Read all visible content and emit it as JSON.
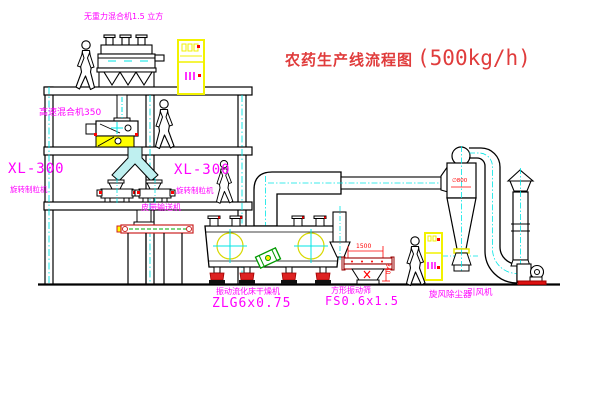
{
  "title": {
    "text": "农药生产线流程图",
    "capacity": "(500kg/h)"
  },
  "labels": {
    "gravity_mixer": "无重力混合机1.5 立方",
    "high_speed_mixer": "高速混合机350",
    "granulator_model_1": "XL-300",
    "granulator_name_1": "旋转制粒机",
    "granulator_model_2": "XL-300",
    "granulator_name_2": "旋转制粒机",
    "belt_conveyor": "皮带输送机",
    "fluid_bed_dryer": "振动流化床干燥机",
    "fluid_bed_dryer_model": "ZLG6x0.75",
    "vibrating_sieve": "方形振动筛",
    "vibrating_sieve_model": "FS0.6x1.5",
    "cyclone_dust_collector": "旋风除尘器",
    "induced_draft_fan": "引风机"
  },
  "dimensions": {
    "sieve_length": "1500",
    "sieve_outlet_height": "340",
    "cyclone_diameter": "∅800"
  },
  "colors": {
    "label_magenta": "#ff00ff",
    "title_red": "#e03c3c",
    "dimension_red": "#ff0000",
    "centerline_cyan": "#00e5e5",
    "cabinet_yellow": "#f2f200",
    "mount_red": "#dd2222",
    "motor_green": "#009900",
    "line_black": "#000000",
    "background": "#ffffff"
  }
}
